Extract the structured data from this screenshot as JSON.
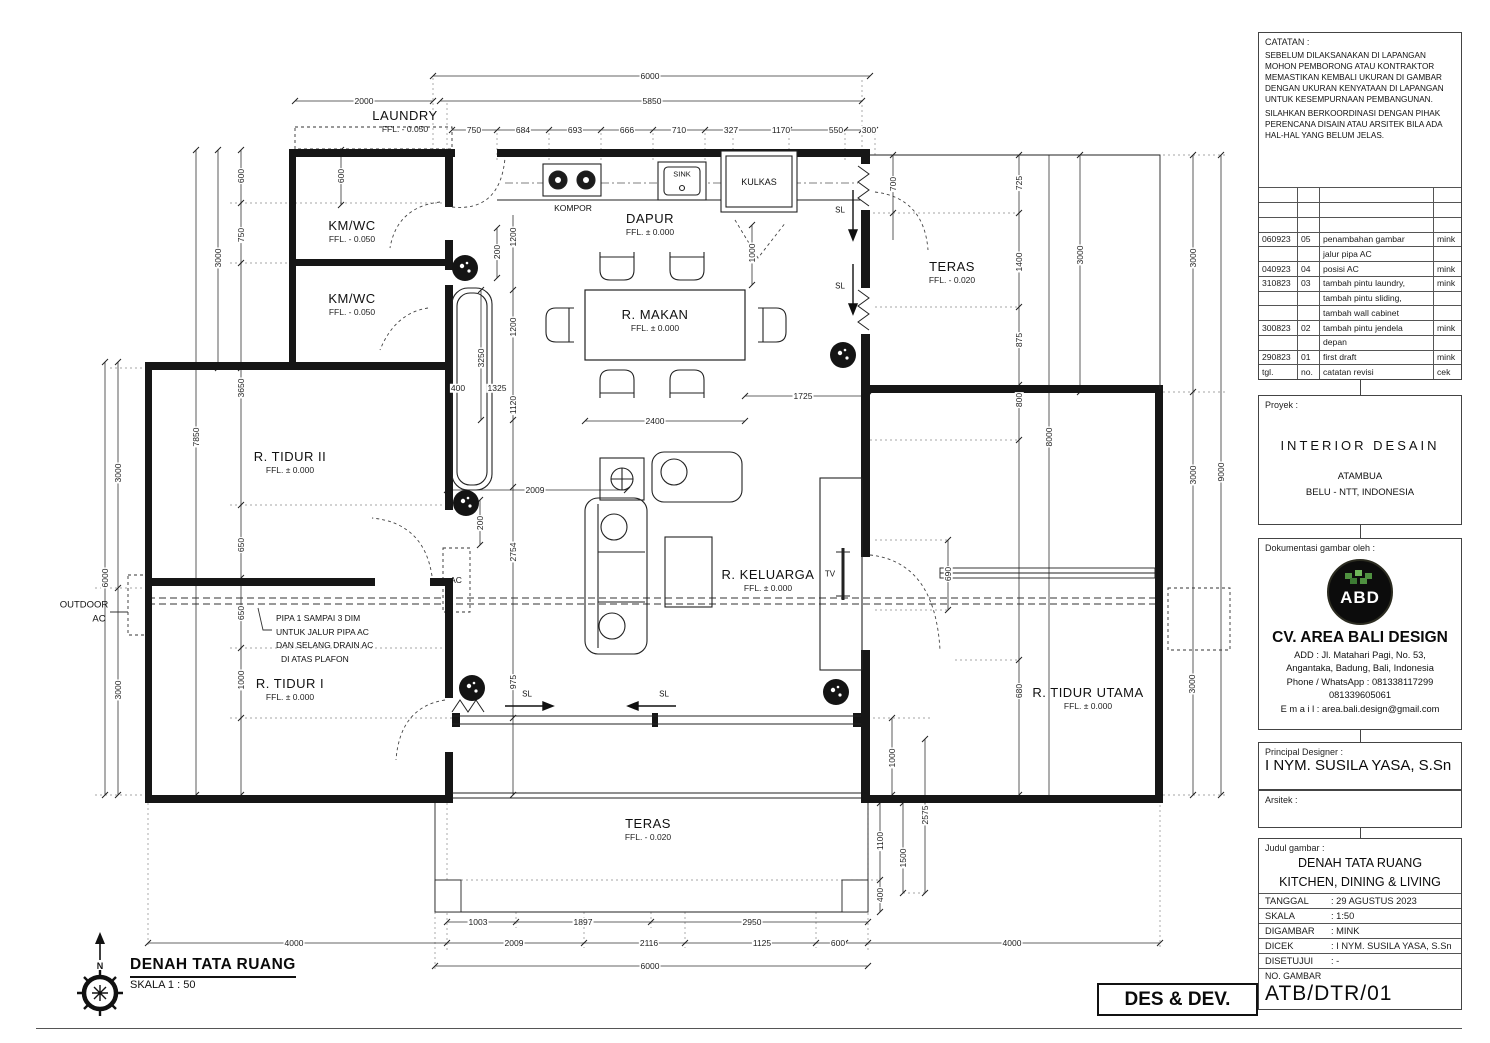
{
  "title_block": {
    "catatan": {
      "label": "CATATAN :",
      "para1": "SEBELUM DILAKSANAKAN DI LAPANGAN MOHON PEMBORONG ATAU KONTRAKTOR MEMASTIKAN KEMBALI UKURAN DI GAMBAR DENGAN UKURAN KENYATAAN DI LAPANGAN UNTUK KESEMPURNAAN PEMBANGUNAN.",
      "para2": "SILAHKAN BERKOORDINASI DENGAN PIHAK PERENCANA DISAIN ATAU ARSITEK BILA ADA HAL-HAL YANG BELUM JELAS."
    },
    "revisions": {
      "rows": [
        {
          "tgl": "060923",
          "no": "05",
          "note": "penambahan gambar",
          "cek": "mink"
        },
        {
          "tgl": "",
          "no": "",
          "note": "jalur pipa AC",
          "cek": ""
        },
        {
          "tgl": "040923",
          "no": "04",
          "note": "posisi AC",
          "cek": "mink"
        },
        {
          "tgl": "310823",
          "no": "03",
          "note": "tambah pintu laundry,",
          "cek": "mink"
        },
        {
          "tgl": "",
          "no": "",
          "note": "tambah pintu sliding,",
          "cek": ""
        },
        {
          "tgl": "",
          "no": "",
          "note": "tambah wall cabinet",
          "cek": ""
        },
        {
          "tgl": "300823",
          "no": "02",
          "note": "tambah pintu jendela",
          "cek": "mink"
        },
        {
          "tgl": "",
          "no": "",
          "note": "depan",
          "cek": ""
        },
        {
          "tgl": "290823",
          "no": "01",
          "note": "first draft",
          "cek": "mink"
        },
        {
          "tgl": "tgl.",
          "no": "no.",
          "note": "catatan revisi",
          "cek": "cek"
        }
      ]
    },
    "proyek": {
      "label": "Proyek :",
      "name": "INTERIOR DESAIN",
      "loc1": "ATAMBUA",
      "loc2": "BELU - NTT, INDONESIA"
    },
    "dokumentasi": {
      "label": "Dokumentasi gambar oleh :",
      "logo_text": "ABD",
      "company": "CV. AREA BALI DESIGN",
      "add1": "ADD : Jl. Matahari Pagi, No. 53,",
      "add2": "Angantaka, Badung, Bali, Indonesia",
      "phone1": "Phone / WhatsApp :  081338117299",
      "phone2": "081339605061",
      "email": "E m a i l : area.bali.design@gmail.com"
    },
    "designer": {
      "label": "Principal Designer :",
      "name": "I NYM. SUSILA YASA, S.Sn",
      "arsitek_label": "Arsitek :"
    },
    "judul": {
      "label": "Judul gambar :",
      "line1": "DENAH TATA RUANG",
      "line2": "KITCHEN, DINING & LIVING",
      "meta": [
        [
          "TANGGAL",
          ":  29 AGUSTUS 2023"
        ],
        [
          "SKALA",
          ":  1:50"
        ],
        [
          "DIGAMBAR",
          ":  MINK"
        ],
        [
          "DICEK",
          ":  I NYM. SUSILA YASA, S.Sn"
        ],
        [
          "DISETUJUI",
          ":  -"
        ]
      ],
      "no_gambar_label": "NO. GAMBAR",
      "no_gambar": "ATB/DTR/01"
    },
    "des_dev": "DES & DEV."
  },
  "plan": {
    "rooms": [
      {
        "name": "LAUNDRY",
        "ffl": "FFL. - 0.050"
      },
      {
        "name": "KM/WC",
        "ffl": "FFL. - 0.050"
      },
      {
        "name": "KM/WC",
        "ffl": "FFL. - 0.050"
      },
      {
        "name": "DAPUR",
        "ffl": "FFL. ± 0.000"
      },
      {
        "name": "R. MAKAN",
        "ffl": "FFL. ± 0.000"
      },
      {
        "name": "TERAS",
        "ffl": "FFL. - 0.020"
      },
      {
        "name": "R. TIDUR II",
        "ffl": "FFL. ± 0.000"
      },
      {
        "name": "R. KELUARGA",
        "ffl": "FFL. ± 0.000"
      },
      {
        "name": "R. TIDUR I",
        "ffl": "FFL. ± 0.000"
      },
      {
        "name": "R. TIDUR UTAMA",
        "ffl": "FFL. ± 0.000"
      },
      {
        "name": "TERAS",
        "ffl": "FFL. - 0.020"
      }
    ],
    "fixtures": {
      "kompor": "KOMPOR",
      "sink": "SINK",
      "kulkas": "KULKAS",
      "tv": "TV",
      "ac": "AC",
      "outdoor1": "OUTDOOR",
      "outdoor2": "AC",
      "sl": "SL",
      "north": "N"
    },
    "ac_note": [
      "PIPA 1 SAMPAI 3 DIM",
      "UNTUK JALUR PIPA AC",
      "DAN SELANG DRAIN AC",
      "DI ATAS PLAFON"
    ],
    "dims": [
      "6000",
      "2000",
      "5850",
      "750",
      "684",
      "693",
      "666",
      "710",
      "327",
      "1170",
      "550",
      "300",
      "700",
      "725",
      "1400",
      "875",
      "3000",
      "3000",
      "800",
      "690",
      "680",
      "8000",
      "3000",
      "9000",
      "3000",
      "600",
      "600",
      "750",
      "3000",
      "3650",
      "7850",
      "3000",
      "6000",
      "3000",
      "650",
      "650",
      "1000",
      "200",
      "1200",
      "1200",
      "3250",
      "400",
      "1325",
      "1120",
      "2400",
      "1725",
      "1000",
      "2009",
      "200",
      "2754",
      "975",
      "1003",
      "1897",
      "2950",
      "2009",
      "2116",
      "1125",
      "600",
      "6000",
      "4000",
      "4000",
      "1000",
      "2575",
      "1100",
      "1500",
      "400"
    ]
  },
  "footer": {
    "title": "DENAH TATA RUANG",
    "scale": "SKALA 1 : 50"
  }
}
